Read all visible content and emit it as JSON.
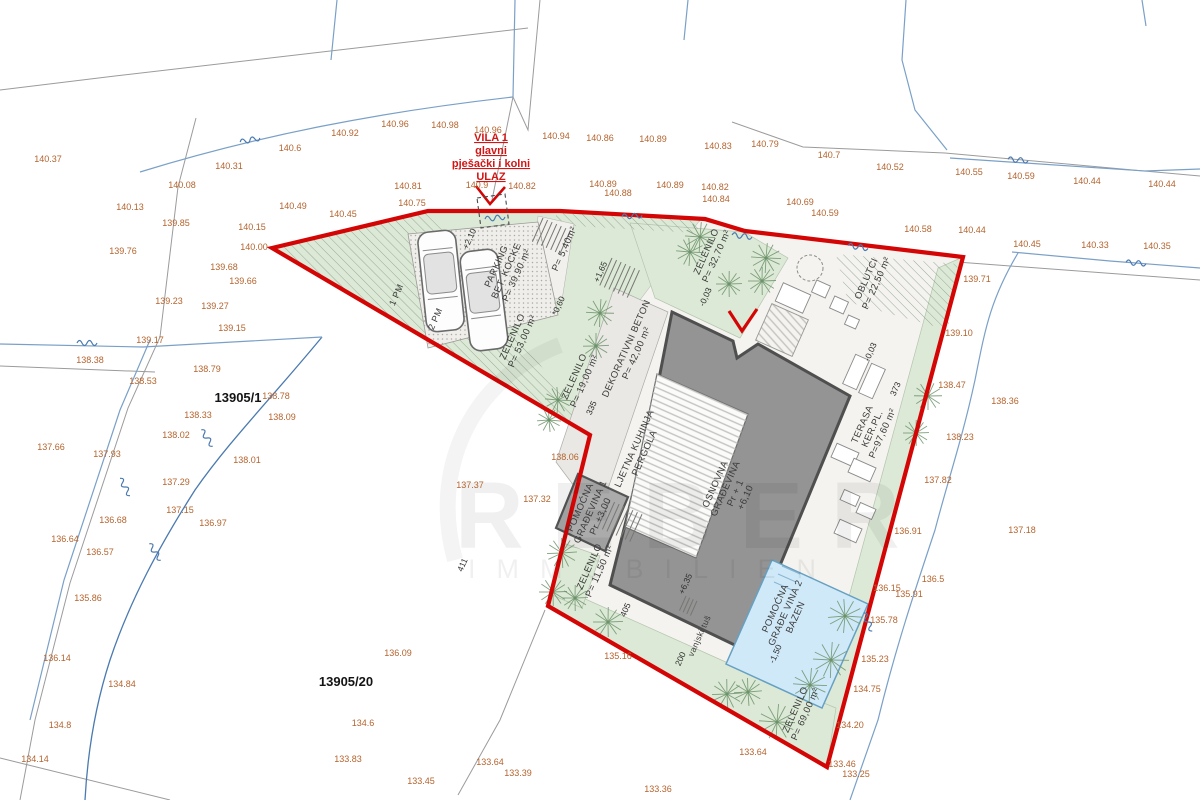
{
  "watermark": {
    "line1": "REBER",
    "line2": "IMMOBILIEN"
  },
  "entrance_label": {
    "lines": [
      "VILA 1",
      "glavni",
      "pješački i kolni",
      "ULAZ"
    ]
  },
  "parcels": [
    {
      "id": "13905/1",
      "x": 238,
      "y": 402
    },
    {
      "id": "13905/20",
      "x": 346,
      "y": 686
    }
  ],
  "area_labels": [
    {
      "x": 509,
      "y": 272,
      "rot": -66,
      "lines": [
        "PARKING",
        "BET. KOCKE",
        "P= 39,90 m²"
      ]
    },
    {
      "x": 567,
      "y": 250,
      "rot": -66,
      "lines": [
        "P= 5,40m²"
      ]
    },
    {
      "x": 520,
      "y": 340,
      "rot": -66,
      "lines": [
        "ZELENILO",
        "P= 53,00 m²"
      ]
    },
    {
      "x": 582,
      "y": 380,
      "rot": -66,
      "lines": [
        "ZELENILO",
        "P= 19,00 m²"
      ]
    },
    {
      "x": 634,
      "y": 352,
      "rot": -66,
      "lines": [
        "DEKORATIVNI BETON",
        "P= 42,00 m²"
      ]
    },
    {
      "x": 714,
      "y": 255,
      "rot": -66,
      "lines": [
        "ZELENILO",
        "P= 32,70 m²"
      ]
    },
    {
      "x": 874,
      "y": 282,
      "rot": -66,
      "lines": [
        "OBLUTCI",
        "P= 22,50 m²"
      ]
    },
    {
      "x": 875,
      "y": 430,
      "rot": -66,
      "lines": [
        "TERASA",
        "KER.PL.",
        "P=97,60 m²"
      ]
    },
    {
      "x": 733,
      "y": 492,
      "rot": -66,
      "lines": [
        "OSNOVNA",
        "GRAĐEVINA",
        "Pr + 1",
        "+6,10"
      ]
    },
    {
      "x": 642,
      "y": 452,
      "rot": -66,
      "lines": [
        "LJETNA KUHINJA",
        "PERGOLA"
      ]
    },
    {
      "x": 593,
      "y": 513,
      "rot": -66,
      "lines": [
        "POMOĆNA",
        "GRAĐEVINA 1",
        "Pr +3,00"
      ]
    },
    {
      "x": 597,
      "y": 570,
      "rot": -66,
      "lines": [
        "ZELENILO",
        "P= 11,50 m²"
      ]
    },
    {
      "x": 788,
      "y": 614,
      "rot": -66,
      "lines": [
        "POMOĆNA",
        "GRAĐE VINA 2",
        "BAZEN"
      ]
    },
    {
      "x": 803,
      "y": 713,
      "rot": -66,
      "lines": [
        "ZELENILO",
        "P= 69,00 m²"
      ]
    },
    {
      "x": 702,
      "y": 637,
      "rot": -66,
      "size": 8.5,
      "lines": [
        "vanjski tuš"
      ]
    },
    {
      "x": 399,
      "y": 296,
      "rot": -66,
      "size": 9,
      "lines": [
        "1 PM"
      ]
    },
    {
      "x": 438,
      "y": 320,
      "rot": -66,
      "size": 9,
      "lines": [
        "2 PM"
      ]
    }
  ],
  "level_marks": [
    {
      "x": 472,
      "y": 240,
      "v": "+2,10"
    },
    {
      "x": 603,
      "y": 273,
      "v": "+1,65"
    },
    {
      "x": 561,
      "y": 307,
      "v": "*0,60"
    },
    {
      "x": 708,
      "y": 298,
      "v": "-0,03"
    },
    {
      "x": 873,
      "y": 353,
      "v": "-0,03"
    },
    {
      "x": 688,
      "y": 585,
      "v": "+6,35"
    },
    {
      "x": 778,
      "y": 655,
      "v": "-1,50"
    },
    {
      "x": 683,
      "y": 660,
      "v": "200"
    },
    {
      "x": 628,
      "y": 611,
      "v": "405"
    },
    {
      "x": 898,
      "y": 390,
      "v": "373"
    },
    {
      "x": 465,
      "y": 566,
      "v": "411"
    },
    {
      "x": 594,
      "y": 409,
      "v": "335"
    }
  ],
  "spot_elevations": [
    [
      48,
      162,
      "140.37"
    ],
    [
      290,
      151,
      "140.6"
    ],
    [
      229,
      169,
      "140.31"
    ],
    [
      182,
      188,
      "140.08"
    ],
    [
      130,
      210,
      "140.13"
    ],
    [
      176,
      226,
      "139.85"
    ],
    [
      252,
      230,
      "140.15"
    ],
    [
      254,
      250,
      "140.00"
    ],
    [
      123,
      254,
      "139.76"
    ],
    [
      224,
      270,
      "139.68"
    ],
    [
      243,
      284,
      "139.66"
    ],
    [
      169,
      304,
      "139.23"
    ],
    [
      215,
      309,
      "139.27"
    ],
    [
      232,
      331,
      "139.15"
    ],
    [
      345,
      136,
      "140.92"
    ],
    [
      395,
      127,
      "140.96"
    ],
    [
      445,
      128,
      "140.98"
    ],
    [
      488,
      133,
      "140.96"
    ],
    [
      556,
      139,
      "140.94"
    ],
    [
      600,
      141,
      "140.86"
    ],
    [
      653,
      142,
      "140.89"
    ],
    [
      718,
      149,
      "140.83"
    ],
    [
      765,
      147,
      "140.79"
    ],
    [
      829,
      158,
      "140.7"
    ],
    [
      890,
      170,
      "140.52"
    ],
    [
      969,
      175,
      "140.55"
    ],
    [
      1021,
      179,
      "140.59"
    ],
    [
      1087,
      184,
      "140.44"
    ],
    [
      1162,
      187,
      "140.44"
    ],
    [
      293,
      209,
      "140.49"
    ],
    [
      343,
      217,
      "140.45"
    ],
    [
      412,
      206,
      "140.75"
    ],
    [
      408,
      189,
      "140.81"
    ],
    [
      477,
      188,
      "140.9"
    ],
    [
      522,
      189,
      "140.82"
    ],
    [
      603,
      187,
      "140.89"
    ],
    [
      618,
      196,
      "140.88"
    ],
    [
      670,
      188,
      "140.89"
    ],
    [
      715,
      190,
      "140.82"
    ],
    [
      716,
      202,
      "140.84"
    ],
    [
      800,
      205,
      "140.69"
    ],
    [
      825,
      216,
      "140.59"
    ],
    [
      918,
      232,
      "140.58"
    ],
    [
      972,
      233,
      "140.44"
    ],
    [
      1027,
      247,
      "140.45"
    ],
    [
      1095,
      248,
      "140.33"
    ],
    [
      1157,
      249,
      "140.35"
    ],
    [
      977,
      282,
      "139.71"
    ],
    [
      959,
      336,
      "139.10"
    ],
    [
      952,
      388,
      "138.47"
    ],
    [
      1005,
      404,
      "138.36"
    ],
    [
      960,
      440,
      "138.23"
    ],
    [
      938,
      483,
      "137.82"
    ],
    [
      1022,
      533,
      "137.18"
    ],
    [
      933,
      582,
      "136.5"
    ],
    [
      908,
      534,
      "136.91"
    ],
    [
      887,
      591,
      "136.15"
    ],
    [
      909,
      597,
      "135.91"
    ],
    [
      884,
      623,
      "135.78"
    ],
    [
      875,
      662,
      "135.23"
    ],
    [
      867,
      692,
      "134.75"
    ],
    [
      850,
      728,
      "134.20"
    ],
    [
      842,
      767,
      "133.46"
    ],
    [
      856,
      777,
      "133.25"
    ],
    [
      753,
      755,
      "133.64"
    ],
    [
      150,
      343,
      "139.17"
    ],
    [
      90,
      363,
      "138.38"
    ],
    [
      143,
      384,
      "138.53"
    ],
    [
      207,
      372,
      "138.79"
    ],
    [
      276,
      399,
      "138.78"
    ],
    [
      282,
      420,
      "138.09"
    ],
    [
      198,
      418,
      "138.33"
    ],
    [
      176,
      438,
      "138.02"
    ],
    [
      51,
      450,
      "137.66"
    ],
    [
      107,
      457,
      "137.93"
    ],
    [
      247,
      463,
      "138.01"
    ],
    [
      176,
      485,
      "137.29"
    ],
    [
      180,
      513,
      "137.15"
    ],
    [
      113,
      523,
      "136.68"
    ],
    [
      213,
      526,
      "136.97"
    ],
    [
      65,
      542,
      "136.64"
    ],
    [
      100,
      555,
      "136.57"
    ],
    [
      88,
      601,
      "135.86"
    ],
    [
      57,
      661,
      "136.14"
    ],
    [
      122,
      687,
      "134.84"
    ],
    [
      60,
      728,
      "134.8"
    ],
    [
      35,
      762,
      "134.14"
    ],
    [
      398,
      656,
      "136.09"
    ],
    [
      363,
      726,
      "134.6"
    ],
    [
      348,
      762,
      "133.83"
    ],
    [
      421,
      784,
      "133.45"
    ],
    [
      490,
      765,
      "133.64"
    ],
    [
      518,
      776,
      "133.39"
    ],
    [
      658,
      792,
      "133.36"
    ],
    [
      565,
      460,
      "138.06"
    ],
    [
      470,
      488,
      "137.37"
    ],
    [
      537,
      502,
      "137.32"
    ],
    [
      618,
      659,
      "135.16"
    ]
  ],
  "site": {
    "trees": [
      [
        700,
        237,
        15
      ],
      [
        690,
        252,
        14
      ],
      [
        766,
        258,
        15
      ],
      [
        762,
        281,
        14
      ],
      [
        729,
        284,
        13
      ],
      [
        600,
        313,
        14
      ],
      [
        596,
        346,
        13
      ],
      [
        558,
        400,
        13
      ],
      [
        549,
        420,
        12
      ],
      [
        562,
        553,
        15
      ],
      [
        553,
        592,
        14
      ],
      [
        575,
        598,
        13
      ],
      [
        608,
        622,
        15
      ],
      [
        727,
        694,
        15
      ],
      [
        748,
        692,
        14
      ],
      [
        777,
        722,
        18
      ],
      [
        810,
        685,
        17
      ],
      [
        831,
        660,
        18
      ],
      [
        845,
        616,
        17
      ],
      [
        928,
        396,
        14
      ],
      [
        916,
        433,
        13
      ]
    ],
    "contour_marks": [
      [
        250,
        140,
        -12
      ],
      [
        87,
        343,
        0
      ],
      [
        207,
        438,
        55
      ],
      [
        155,
        552,
        55
      ],
      [
        125,
        487,
        60
      ],
      [
        495,
        218,
        -6
      ],
      [
        632,
        216,
        -4
      ],
      [
        742,
        236,
        6
      ],
      [
        858,
        247,
        8
      ],
      [
        868,
        622,
        65
      ],
      [
        1018,
        160,
        4
      ],
      [
        1136,
        263,
        4
      ]
    ]
  },
  "colors": {
    "boundary_red": "#d40505",
    "green_zone": "#dce9d6",
    "building_gray": "#949494",
    "pool_blue": "#cfe9f8",
    "elevation_text": "#b5642e",
    "contour_blue": "#7aa0c8"
  }
}
